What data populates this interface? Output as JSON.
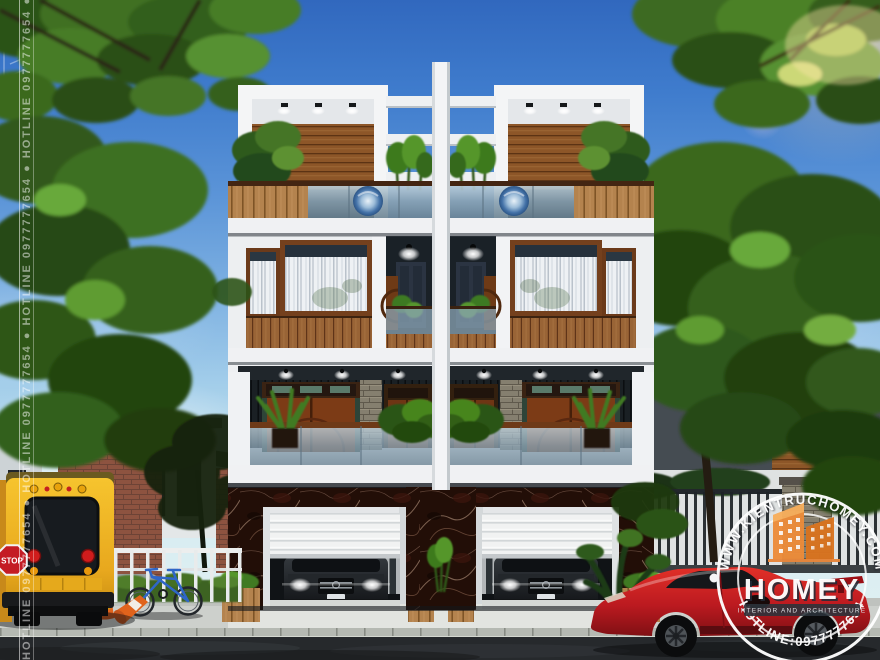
{
  "watermarks": {
    "side_vertical_text": "HOTLINE 0977777654 ● HOTLINE 0977777654 ● HOTLINE 0977777654 ● HOTLINE 0977777654 ● HOTLINE 0977777654",
    "corner_logo": {
      "brand": "HOMEY",
      "tagline": "INTERIOR AND ARCHITECTURE",
      "color": "#D9832E"
    },
    "stamp": {
      "arc_top": "WWW.KIENTRUCHOMEY.COM",
      "brand": "HOMEY",
      "tagline": "INTERIOR AND ARCHITECTURE",
      "arc_bottom": "HOTLINE:0977777654",
      "orange": "#E8863B",
      "ring_color": "#FFFFFF"
    }
  },
  "street_scene": {
    "stop_sign_label": "STOP",
    "school_bus_color": "#F2B21E",
    "sports_car_color": "#C2181F"
  },
  "building_palette": {
    "sky_top": "#3770C6",
    "sky_horizon": "#D8EEF2",
    "slab_white": "#F0F1F3",
    "wood_slat": "#8D5628",
    "marble_base": "#2A1208",
    "foliage_green": "#3F6B1F",
    "glass_blue": "#8AA2B2"
  }
}
